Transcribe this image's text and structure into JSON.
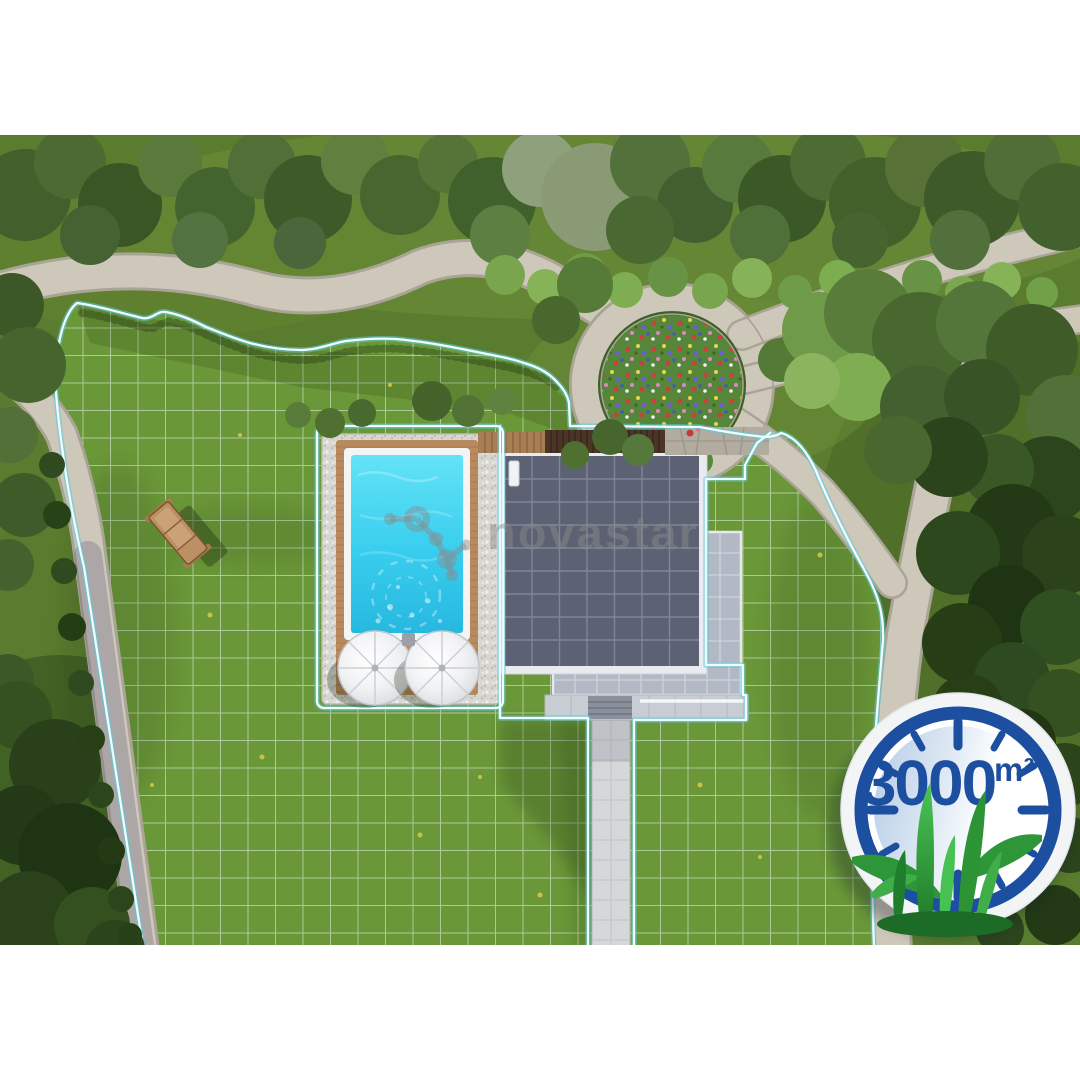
{
  "brand": {
    "watermark_text": "novastar"
  },
  "badge": {
    "area_value": "3000",
    "area_unit": "m²"
  },
  "colors": {
    "badge_blue": "#1d4fa0",
    "boundary_cyan": "#9fe9ee",
    "lawn_green": "#6a9738",
    "pool_water": "#3fd4f0",
    "path_stone": "#cec8ba",
    "roof_gray": "#5c6273",
    "grass_blade_green": "#35a23d",
    "letterbox": "#ffffff"
  }
}
